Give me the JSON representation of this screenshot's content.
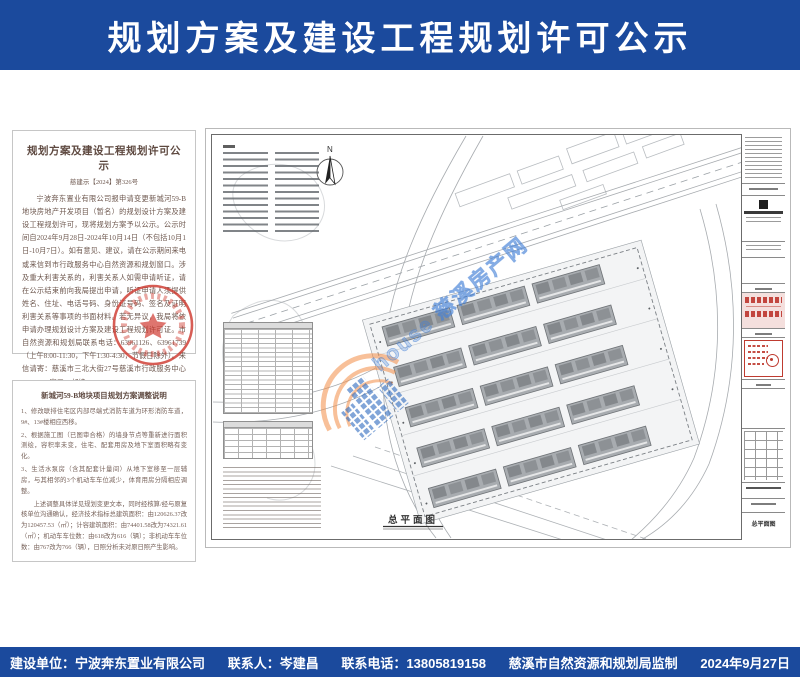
{
  "header": {
    "title": "规划方案及建设工程规划许可公示"
  },
  "notice": {
    "title": "规划方案及建设工程规划许可公示",
    "doc_no": "慈建示【2024】第326号",
    "body": "宁波奔东置业有限公司报申请变更新城河59-B地块房地产开发项目（暂名）的规划设计方案及建设工程规划许可，现将规划方案予以公示。公示时间自2024年9月28日-2024年10月14日（不包括10月1日-10月7日）。如有意见、建议，请在公示期间来电或来信到市行政服务中心自然资源和规划窗口。涉及重大利害关系的，利害关系人如需申请听证，请在公示结束前向我局提出申请，听证申请人须提供姓名、住址、电话号码、身份证号码、签名及证明利害关系等事项的书面材料。若无异议，我局将依申请办理规划设计方案及建设工程规划许可证。市自然资源和规划局联系电话：63961126、63961739（上午8:00-11:30，下午1:30-4:30，节假日除外）。来信请寄：慈溪市三北大街27号慈溪市行政服务中心97#-101#窗口，邮编315300。",
    "org": "慈溪市自然资源和规划局",
    "date": "二〇二四年九月二十七日"
  },
  "adjustment": {
    "title": "新城河59-B地块项目规划方案调整说明",
    "item1": "1、修改联排住宅区内部尽端式消防车道为环形消防车道，9#、13#楼相应西移。",
    "item2": "2、根据施工图（已图审合格）的墙身节点等重新进行面积测绘，容积率未变，住宅、配套用房及地下室面积略有变化。",
    "item3": "3、生活水泵房（含其配套计量间）从地下室移至一层辅房，与其相邻的3个机动车车位减少，体育用房分隔相应调整。",
    "summary": "上述调整具体详见规划变更文本，同时经核算/经与原复核单位沟通确认，经济技术指标总建筑面积：由120626.37改为120457.53（㎡）；计容建筑面积：由74401.58改为74321.61（㎡）；机动车车位数：由618改为616（辆）；非机动车车位数：由767改为766（辆），日照分析未对原日照产生影响。"
  },
  "drawing": {
    "north_label": "N",
    "plan_label": "总平面图",
    "title_block_drawing_name": "总平面图",
    "watermark": "house 慈溪房产网"
  },
  "footer": {
    "items": [
      "建设单位：宁波奔东置业有限公司",
      "联系人：岑建昌",
      "联系电话：13805819158",
      "慈溪市自然资源和规划局监制",
      "2024年9月27日"
    ]
  },
  "colors": {
    "banner_blue": "#1b4a9d",
    "seal_red": "#c0392b",
    "watermark_orange": "#f08c46",
    "watermark_blue": "#4682d2"
  }
}
